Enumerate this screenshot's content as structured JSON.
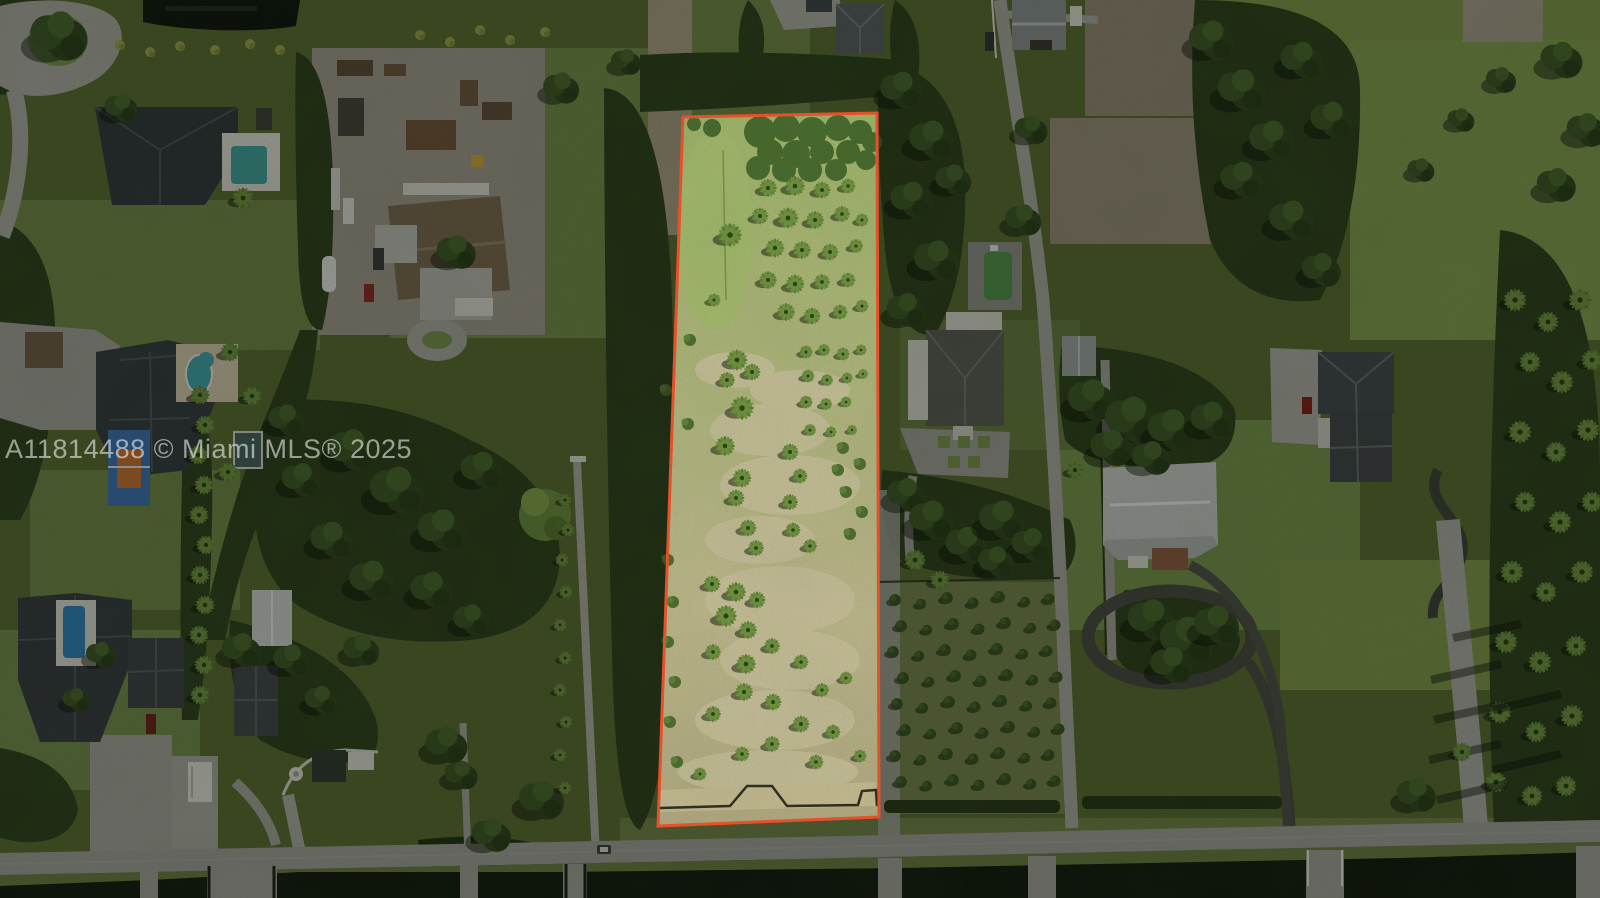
{
  "photo": {
    "watermark_text": "A11814488 © Miami MLS® 2025",
    "boundary_color": "#e5512a",
    "description": "Aerial drone photo of a vacant palm-planted acreage parcel outlined in red, surrounded by large residential estates, a plant nursery yard, dirt fields, a canal and a street along the bottom"
  }
}
